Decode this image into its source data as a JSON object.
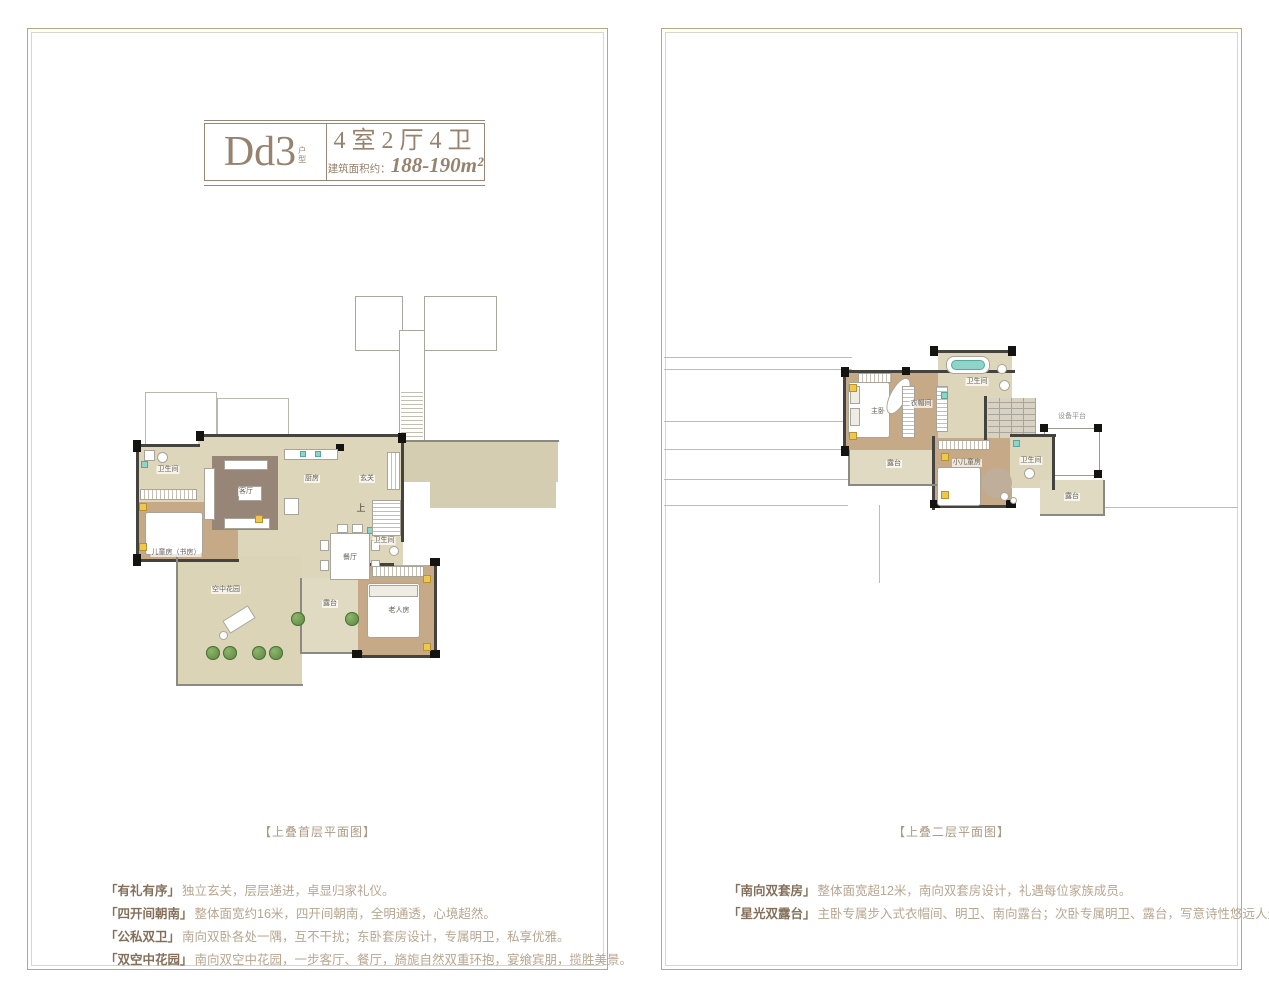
{
  "left_panel": {
    "header": {
      "code": "Dd3",
      "code_tag": "户型",
      "layout": "4室2厅4卫",
      "area_label": "建筑面积约：",
      "area_value": "188-190m²"
    },
    "plan": {
      "caption": "【上叠首层平面图】",
      "rooms": {
        "bath_top": "卫生间",
        "kids": "儿童房（书房）",
        "living": "客厅",
        "kitchen": "厨房",
        "entry": "玄关",
        "dining": "餐厅",
        "up": "上",
        "bath_mid": "卫生间",
        "elder": "老人房",
        "garden": "空中花园",
        "terrace": "露台"
      }
    },
    "features": [
      {
        "title": "「有礼有序」",
        "text": "独立玄关，层层递进，卓显归家礼仪。"
      },
      {
        "title": "「四开间朝南」",
        "text": "整体面宽约16米，四开间朝南，全明通透，心境超然。"
      },
      {
        "title": "「公私双卫」",
        "text": "南向双卧各处一隅，互不干扰；东卧套房设计，专属明卫，私享优雅。"
      },
      {
        "title": "「双空中花园」",
        "text": "南向双空中花园，一步客厅、餐厅，旖旎自然双重环抱，宴飨宾朋，揽胜美景。"
      }
    ]
  },
  "right_panel": {
    "plan": {
      "caption": "【上叠二层平面图】",
      "rooms": {
        "master": "主卧",
        "closet": "衣帽间",
        "bath_top": "卫生间",
        "equip": "设备平台",
        "terrace_left": "露台",
        "kids": "小儿童房",
        "bath_right": "卫生间",
        "terrace_right": "露台"
      }
    },
    "features": [
      {
        "title": "「南向双套房」",
        "text": "整体面宽超12米，南向双套房设计，礼遇每位家族成员。"
      },
      {
        "title": "「星光双露台」",
        "text": "主卧专属步入式衣帽间、明卫、南向露台；次卧专属明卫、露台，写意诗性悠远人生。"
      }
    ]
  },
  "colors": {
    "accent": "#97826d",
    "feature_title": "#84705a",
    "feature_body": "#b7a691",
    "beige": "#ddd6bb",
    "wood": "#c6aa88",
    "wall": "#45433d",
    "plant_green": "#55813f",
    "accent_yellow": "#eec84e",
    "fixture_cyan": "#8fd4c8"
  }
}
